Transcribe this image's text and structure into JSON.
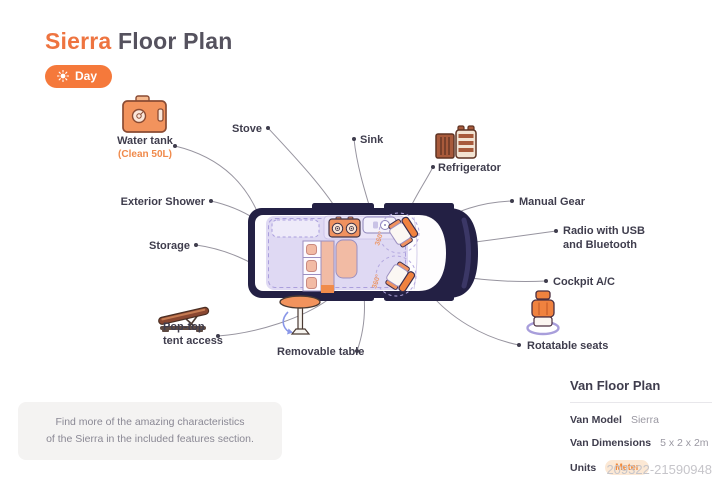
{
  "header": {
    "title_accent": "Sierra",
    "title_rest": " Floor Plan",
    "mode_button": {
      "label": "Day"
    }
  },
  "diagram": {
    "seat_rotation": "360°",
    "labels": {
      "water_tank": "Water tank",
      "water_tank_sub": "(Clean 50L)",
      "stove": "Stove",
      "sink": "Sink",
      "refrigerator": "Refrigerator",
      "manual_gear": "Manual Gear",
      "radio_line1": "Radio with USB",
      "radio_line2": "and Bluetooth",
      "cockpit_ac": "Cockpit A/C",
      "exterior_shower": "Exterior Shower",
      "storage": "Storage",
      "pop_top_line1": "Pop-top",
      "pop_top_line2": "tent access",
      "removable_table": "Removable table",
      "rotatable_seats": "Rotatable seats"
    }
  },
  "note": {
    "line1": "Find more of the amazing characteristics",
    "line2": "of the Sierra in the included features section."
  },
  "info_panel": {
    "title": "Van Floor Plan",
    "rows": [
      {
        "label": "Van Model",
        "value": "Sierra"
      },
      {
        "label": "Van Dimensions",
        "value": "5 x 2 x 2m"
      },
      {
        "label": "Units",
        "value": "Meter"
      }
    ]
  },
  "watermark": "209322-21590948",
  "colors": {
    "accent": "#F0793C",
    "van_body": "#232044",
    "lavender": "#DCD6F2",
    "salmon": "#F2BBA4",
    "seat_orange": "#F0823F",
    "label_dark": "#3F3D4D",
    "leader_line": "#97949F",
    "badge_bg": "#FCE8D4"
  }
}
